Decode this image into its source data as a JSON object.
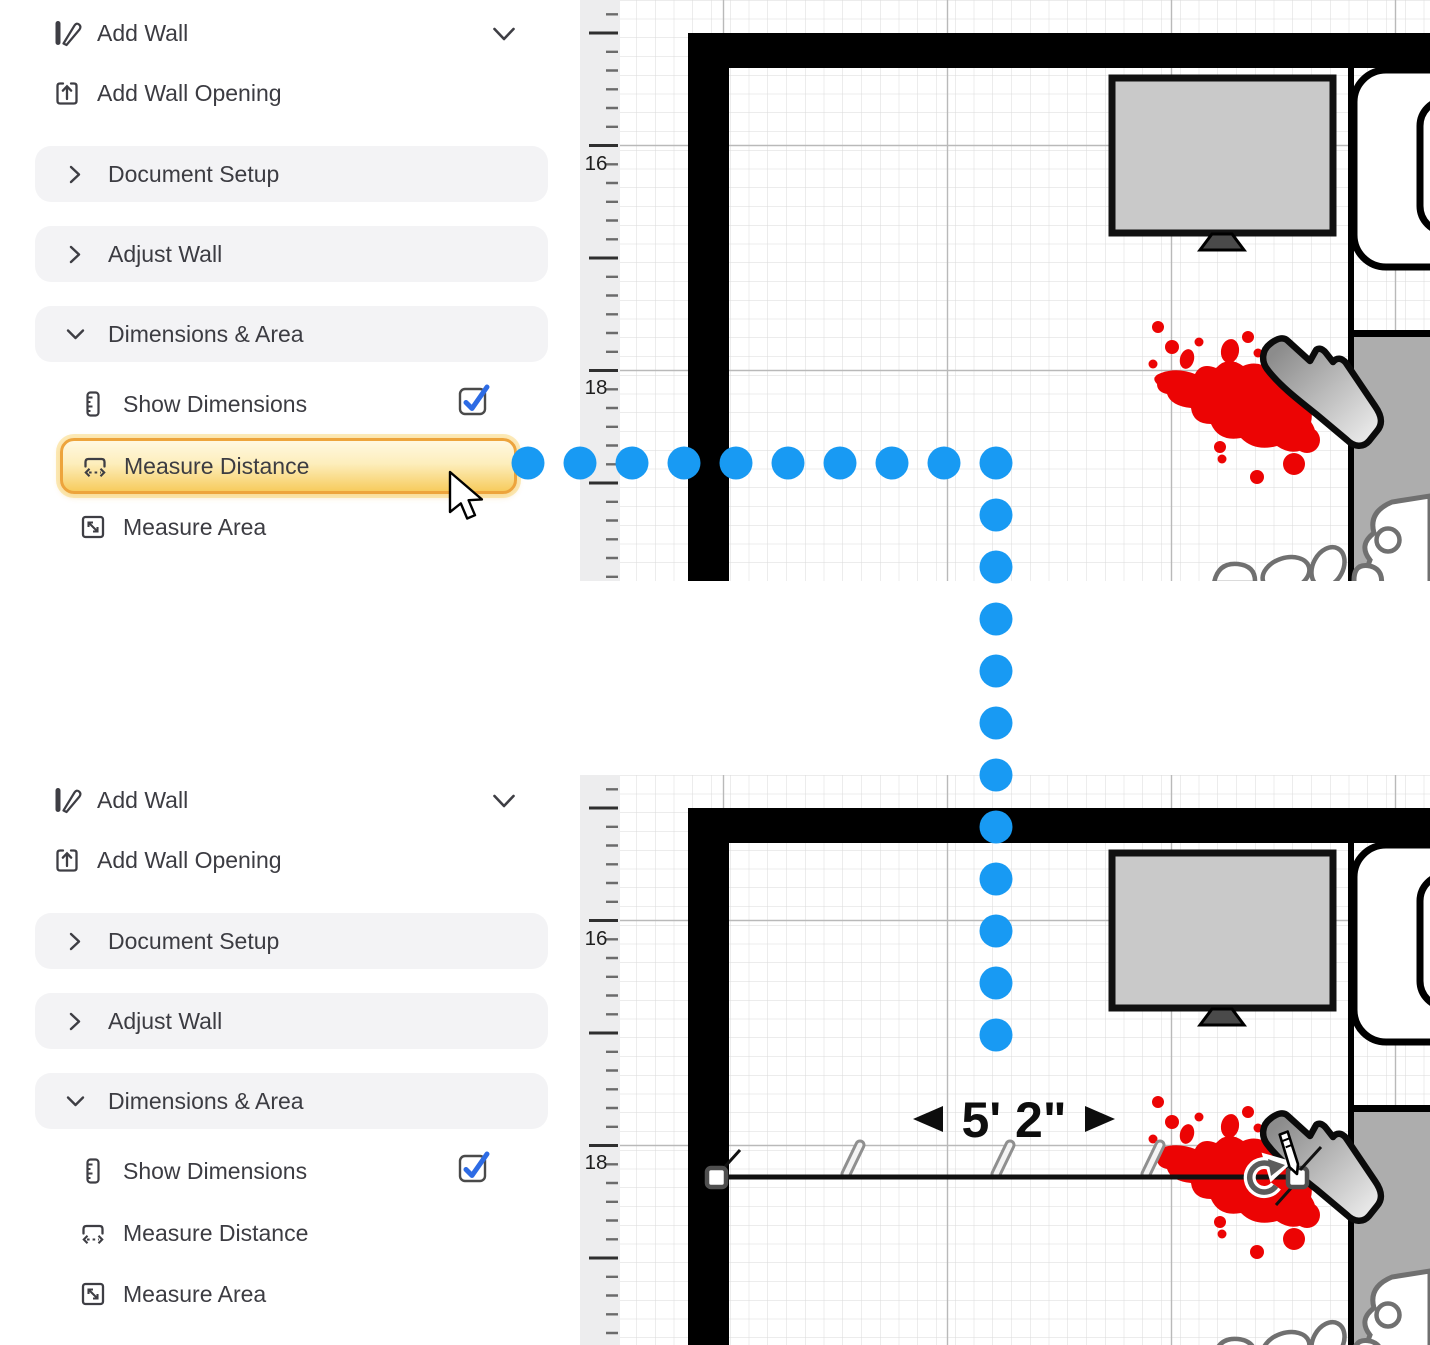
{
  "sidebar": {
    "add_wall": "Add Wall",
    "add_wall_opening": "Add Wall Opening",
    "document_setup": "Document Setup",
    "adjust_wall": "Adjust Wall",
    "dimensions_area": "Dimensions & Area",
    "show_dimensions": "Show Dimensions",
    "measure_distance": "Measure Distance",
    "measure_area": "Measure Area"
  },
  "canvas": {
    "ruler_label_upper": "16",
    "ruler_label_lower": "18",
    "measurement_label": "5' 2\""
  },
  "checkboxes": {
    "show_dimensions_top": true,
    "show_dimensions_bottom": true
  },
  "measure_path": {
    "dot_color": "#189AF3",
    "dot_radius": 16.5,
    "horizontal": {
      "y": 463,
      "x_start": 528,
      "x_step": 52,
      "count": 10
    },
    "vertical": {
      "x": 996,
      "y_start": 515,
      "y_step": 52,
      "count": 11
    }
  },
  "colors": {
    "highlight_border": "#EDA43C",
    "highlight_fill_top": "#FFF8E1",
    "highlight_fill_bottom": "#F7CC5E",
    "checkbox_blue": "#2D6BE4",
    "blood_red": "#EC0404",
    "wall_black": "#000000",
    "tv_gray": "#C9C9C9",
    "outdoor_gray": "#ADADAD"
  }
}
